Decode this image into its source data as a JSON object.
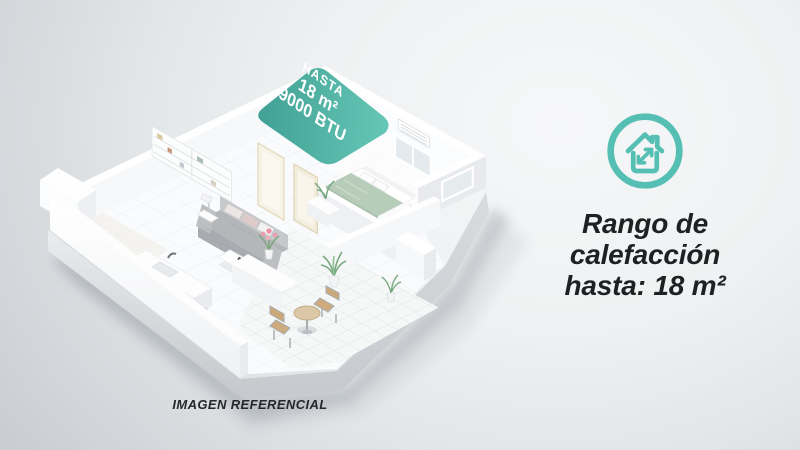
{
  "colors": {
    "accent_teal": "#55bfb3",
    "overlay_teal_dark": "#31998b",
    "overlay_teal_light": "#5cc4b3",
    "heading_text": "#1e2022",
    "background_light": "#f5f6f7",
    "background_dark": "#c3c6ca"
  },
  "floorplan": {
    "roof_label": {
      "line1": "HASTA",
      "line2": "18 m²",
      "line3": "9000 BTU"
    },
    "caption": "IMAGEN REFERENCIAL"
  },
  "info_panel": {
    "icon": "house-expand",
    "heading": {
      "line1": "Rango de",
      "line2": "calefacción",
      "line3": "hasta: 18 m²"
    }
  }
}
